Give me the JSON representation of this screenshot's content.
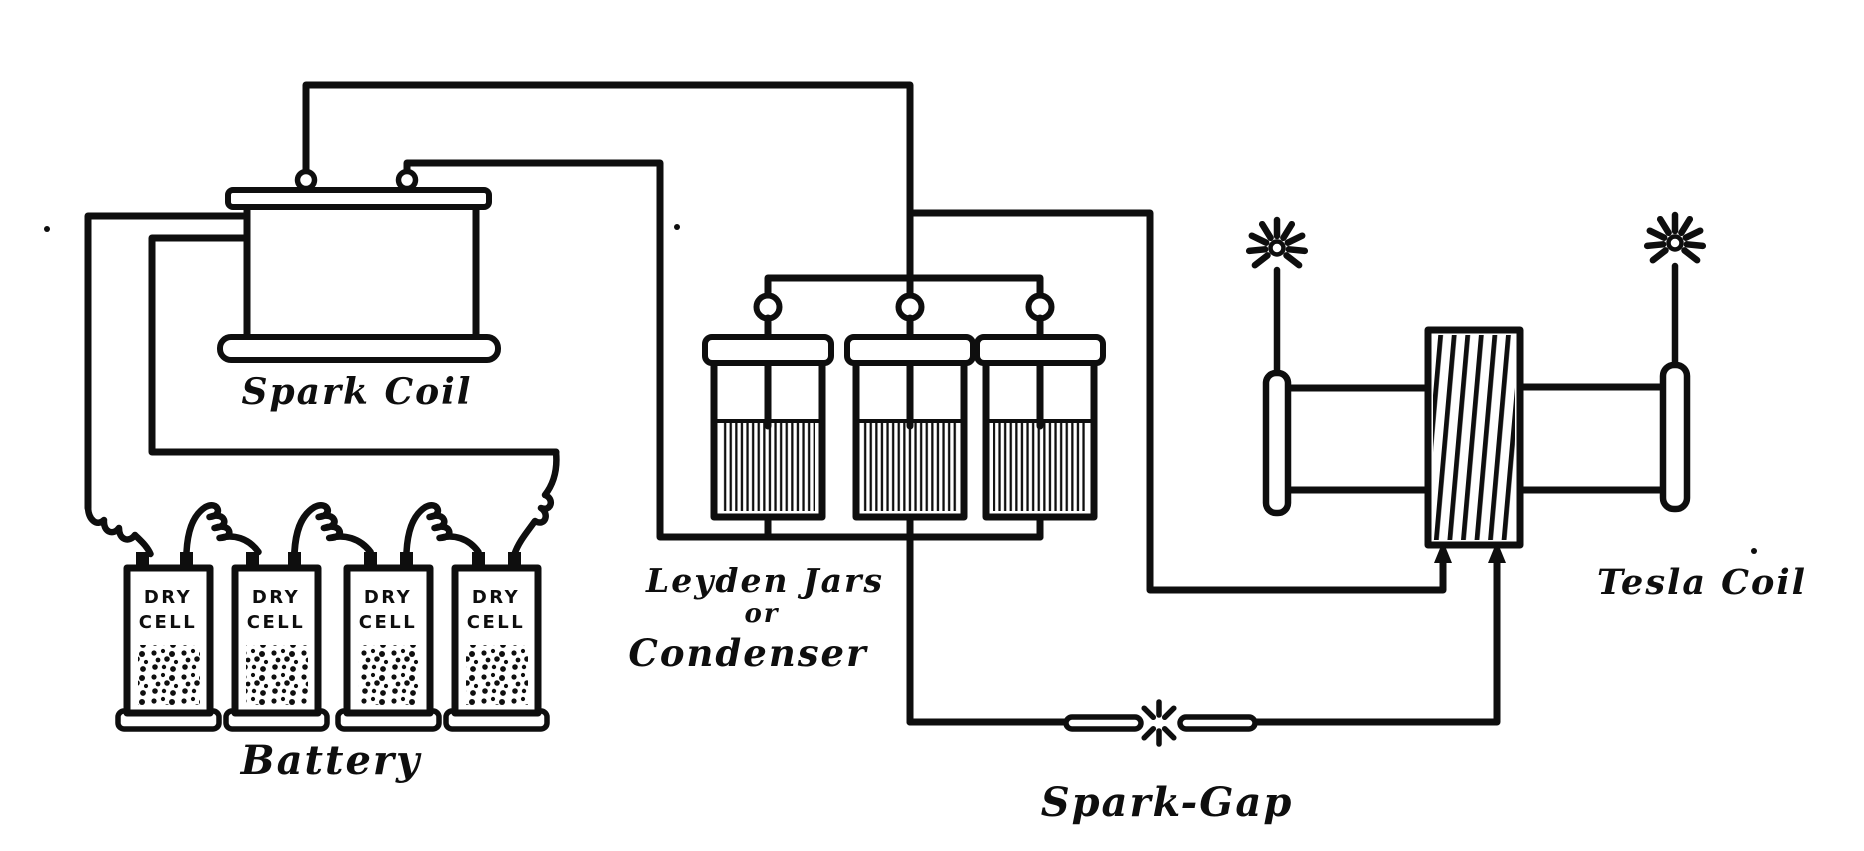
{
  "figure": {
    "kind": "vintage wiring diagram of a Tesla coil apparatus",
    "colors": {
      "ink": "#0e0e0e",
      "paper": "#ffffff"
    }
  },
  "labels": {
    "spark_coil": "Spark Coil",
    "battery": "Battery",
    "condenser_line1": "Leyden Jars",
    "condenser_line2": "or",
    "condenser_line3": "Condenser",
    "spark_gap": "Spark-Gap",
    "tesla_coil": "Tesla Coil"
  },
  "battery": {
    "cells": [
      {
        "line1": "DRY",
        "line2": "CELL"
      },
      {
        "line1": "DRY",
        "line2": "CELL"
      },
      {
        "line1": "DRY",
        "line2": "CELL"
      },
      {
        "line1": "DRY",
        "line2": "CELL"
      }
    ]
  },
  "condenser": {
    "jar_count": 3
  },
  "spark_gap": {
    "electrode_count": 2
  },
  "tesla_coil": {
    "discharge_point_count": 2
  }
}
